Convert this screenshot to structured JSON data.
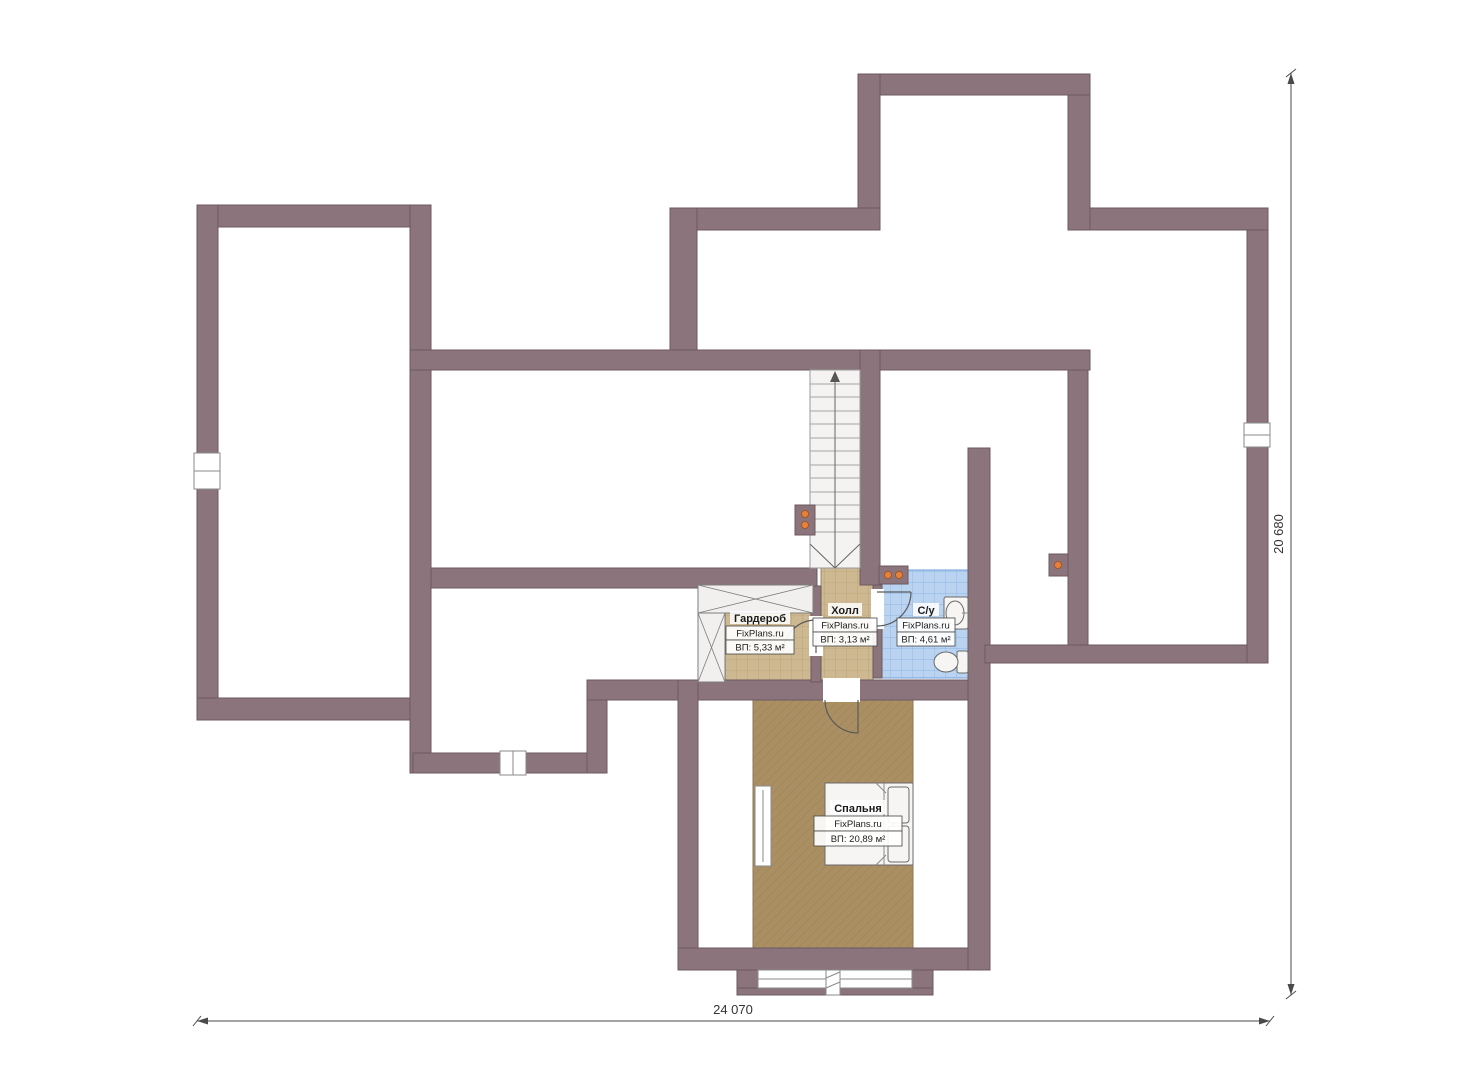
{
  "rooms": [
    {
      "id": "wardrobe",
      "name": "Гардероб",
      "brand": "FixPlans.ru",
      "area": "ВП: 5,33 м²"
    },
    {
      "id": "hall",
      "name": "Холл",
      "brand": "FixPlans.ru",
      "area": "ВП: 3,13 м²"
    },
    {
      "id": "bathroom",
      "name": "С/у",
      "brand": "FixPlans.ru",
      "area": "ВП: 4,61 м²"
    },
    {
      "id": "bedroom",
      "name": "Спальня",
      "brand": "FixPlans.ru",
      "area": "ВП: 20,89 м²"
    }
  ],
  "dimensions": {
    "bottom_width": "24 070",
    "right_height": "20 680"
  },
  "colors": {
    "wall": "#8b747b",
    "wall_edge": "#6d5a61",
    "floor_tile": "#cdb891",
    "floor_tile_line": "#8f7a4e",
    "floor_bedroom": "#aa8f63",
    "floor_bedroom_line": "#93794e",
    "floor_bath": "#b9d3f0",
    "floor_bath_line": "#76a3da",
    "heater_dot": "#e5813b",
    "dim": "#4a4a4a",
    "text": "#1c1c1c"
  }
}
